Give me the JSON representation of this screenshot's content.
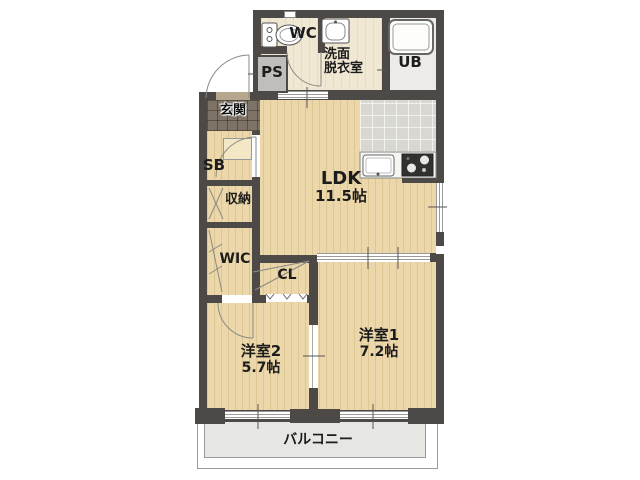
{
  "rooms": {
    "ldk": {
      "label": "LDK",
      "size": "11.5帖"
    },
    "youshitsu1": {
      "label": "洋室1",
      "size": "7.2帖"
    },
    "youshitsu2": {
      "label": "洋室2",
      "size": "5.7帖"
    },
    "balcony": {
      "label": "バルコニー"
    },
    "genkan": {
      "label": "玄関"
    },
    "wic": {
      "label": "WIC"
    },
    "cl": {
      "label": "CL"
    },
    "shuunou": {
      "label": "収納"
    },
    "sb": {
      "label": "SB"
    },
    "wc": {
      "label": "WC"
    },
    "ps": {
      "label": "PS"
    },
    "ub": {
      "label": "UB"
    },
    "senmen": {
      "label_line1": "洗面",
      "label_line2": "脱衣室"
    }
  },
  "icons": {
    "toilet": "toilet-icon",
    "wash_basin": "wash-basin-icon",
    "bathtub": "bathtub-icon",
    "kitchen_sink": "kitchen-sink-icon",
    "stove": "stove-icon"
  },
  "colors": {
    "wall": "#4d4946",
    "wood_floor": "#ebd7a9",
    "genkan_tile": "#7d7366",
    "kitchen_tile": "#d8d7d2",
    "balcony_floor": "#e6e6e3",
    "sanitary_floor": "#f1e8d4",
    "ub_floor": "#ecebe7",
    "line": "#8a8a86"
  }
}
